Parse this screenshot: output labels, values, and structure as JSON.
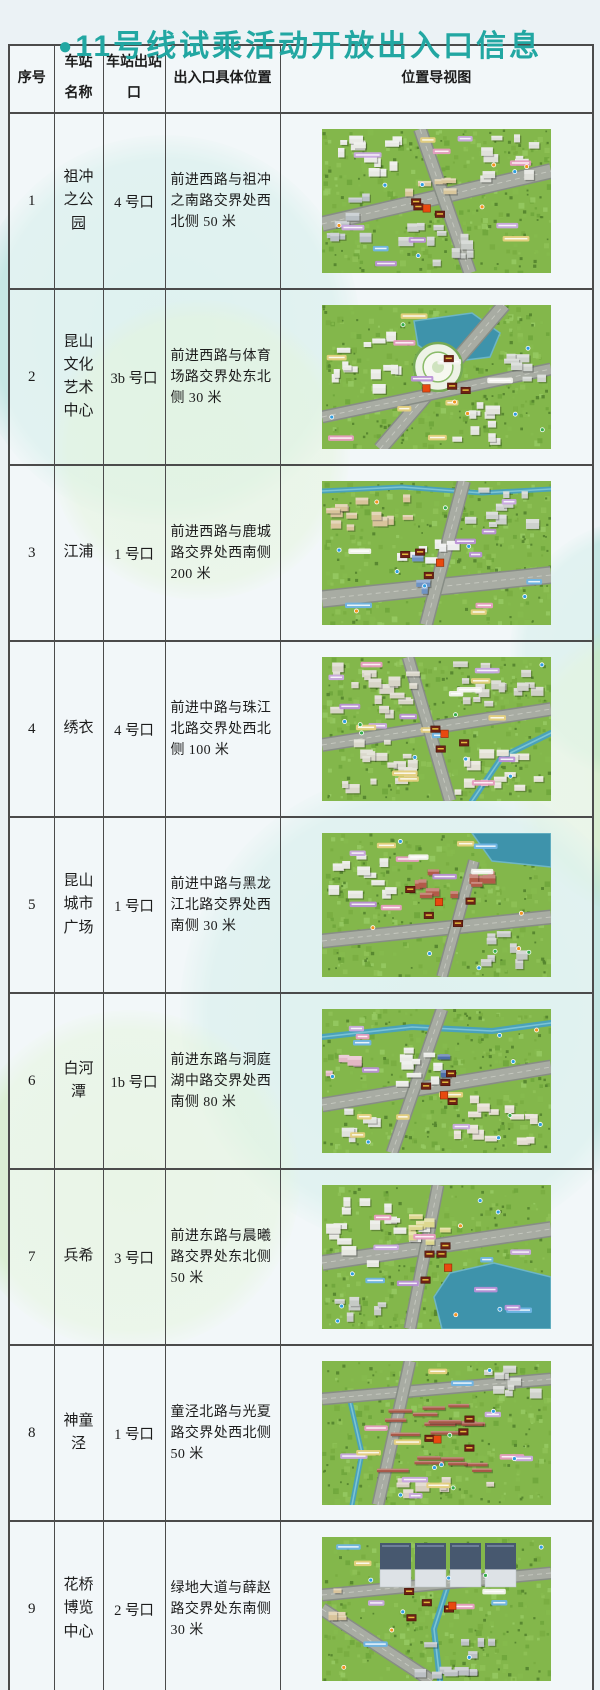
{
  "page": {
    "accent_color": "#22a7a2",
    "border_color": "#4b4b4b",
    "background_color": "#ebf2f5"
  },
  "title": {
    "bullet": "●",
    "text": "11号线试乘活动开放出入口信息"
  },
  "table": {
    "headers": [
      "序号",
      "车站名称",
      "车站出站口",
      "出入口具体位置",
      "位置导视图"
    ]
  },
  "rows": [
    {
      "index": "1",
      "station": "祖冲之公园",
      "exit": "4 号口",
      "location": "前进西路与祖冲之南路交界处西北侧 50 米"
    },
    {
      "index": "2",
      "station": "昆山文化艺术中心",
      "exit": "3b 号口",
      "location": "前进西路与体育场路交界处东北侧 30 米"
    },
    {
      "index": "3",
      "station": "江浦",
      "exit": "1 号口",
      "location": "前进西路与鹿城路交界处西南侧 200 米"
    },
    {
      "index": "4",
      "station": "绣衣",
      "exit": "4 号口",
      "location": "前进中路与珠江北路交界处西北侧 100 米"
    },
    {
      "index": "5",
      "station": "昆山城市广场",
      "exit": "1 号口",
      "location": "前进中路与黑龙江北路交界处西南侧 30 米"
    },
    {
      "index": "6",
      "station": "白河潭",
      "exit": "1b 号口",
      "location": "前进东路与洞庭湖中路交界处西南侧 80 米"
    },
    {
      "index": "7",
      "station": "兵希",
      "exit": "3 号口",
      "location": "前进东路与晨曦路交界处东北侧 50 米"
    },
    {
      "index": "8",
      "station": "神童泾",
      "exit": "1 号口",
      "location": "童泾北路与光夏路交界处西北侧 50 米"
    },
    {
      "index": "9",
      "station": "花桥博览中心",
      "exit": "2 号口",
      "location": "绿地大道与薛赵路交界处东南侧 30 米"
    }
  ]
}
